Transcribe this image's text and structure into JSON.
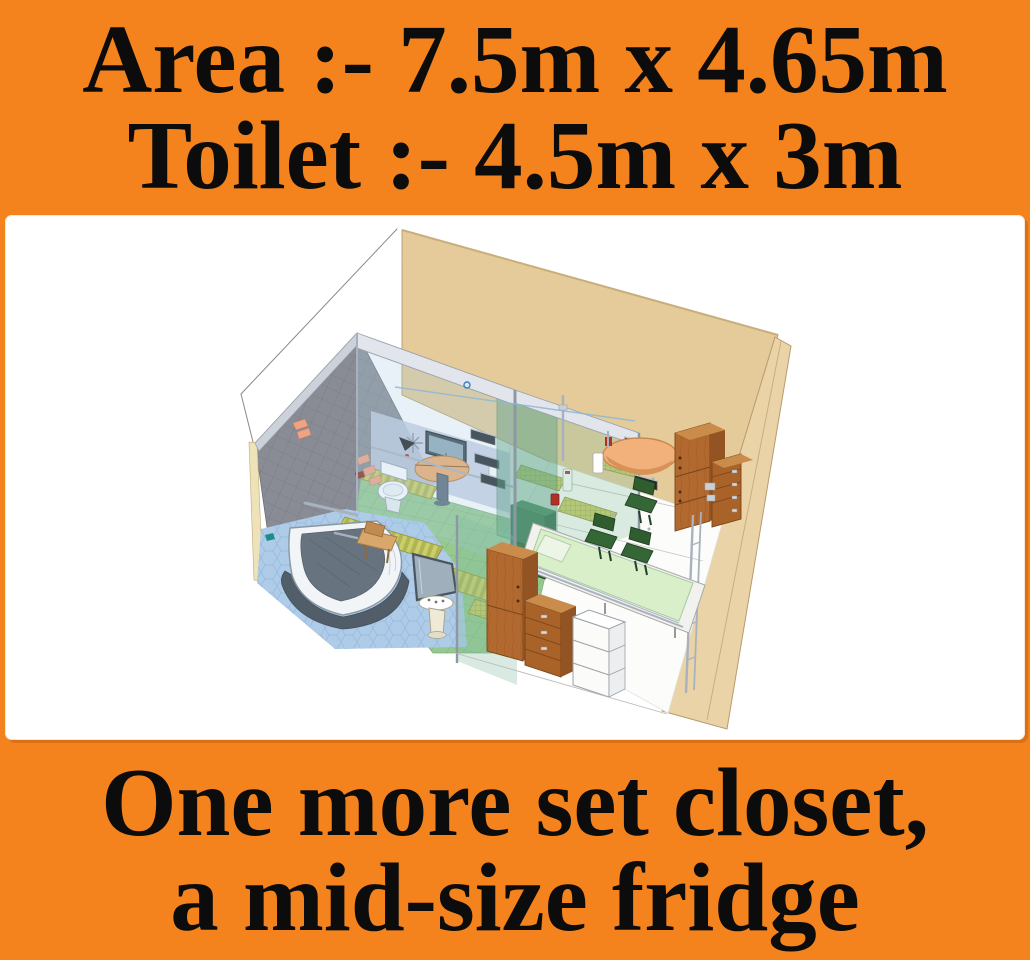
{
  "title": "Room layout promo graphic",
  "header": {
    "line1": "Area :- 7.5m x 4.65m",
    "line2": "Toilet :- 4.5m x 3m"
  },
  "footer": {
    "line1": "One more set closet,",
    "line2": "a mid-size fridge"
  },
  "colors": {
    "background": "#F5831D",
    "panel": "#FFFFFF",
    "text": "#0C0C0C",
    "wireframe": "#8A8A86",
    "back_wall": "#E5CB99",
    "wall_edge": "#C9AE7C",
    "right_wall": "#EAD3A6",
    "gray_wall": "#898C95",
    "cream_strip": "#EDE2B8",
    "wall_cap": "#CDD2DA",
    "inner_wall_blue": "#C5CEE2",
    "floor_white": "#FCFCFB",
    "floor_green": "#95C98F",
    "floor_blue": "#AECBE8",
    "mat_yellow": "#C6CA62",
    "runner_yellow": "#CBCF6A",
    "frame_white": "#E2E6EC",
    "glass_blue": "#A8CDE4",
    "glass_green": "#87BFA5",
    "glass_teal": "#5FA58C",
    "chrome": "#A8B2BE",
    "toilet_white": "#FFFFFF",
    "tv_dark": "#37474F",
    "tv_screen": "#8FA8B8",
    "desk_top": "#EFA96B",
    "desk_leg": "#5A6A78",
    "tub_white": "#F1F5F7",
    "tub_inner": "#67747F",
    "slate": "#515E6A",
    "mirror": "#9FB0BC",
    "sink_cream": "#EFEAD6",
    "stool_wood": "#D8A76B",
    "bag_tan": "#C08A50",
    "wood_front": "#B2692F",
    "wood_side": "#935323",
    "wood_top": "#C98C4B",
    "drawer_wood": "#A96228",
    "fridge_white": "#FBFBFA",
    "fridge_side": "#EDEEEF",
    "bed_deck": "#F1F1EE",
    "bed_green": "#D9EFC9",
    "pillow": "#EDF6E6",
    "chair_green": "#2F5D2F",
    "chair_seat": "#356635",
    "cabinet_green": "#2D6B3F",
    "cabinet_green_side": "#1E4A2B",
    "vanity_peach": "#F2B17A",
    "accent_pink": "#F0A284",
    "accent_red": "#8E2B1E",
    "red_fixture": "#B03226",
    "teal_dish": "#1F8A8A",
    "glyph_blue": "#3A7CC8"
  },
  "scene": {
    "type": "3d-room-render",
    "style": "sketchup-cutaway",
    "objects": [
      "room wireframe",
      "tan back wall",
      "right wall",
      "gray tiled shower wall",
      "glass toilet cubicle",
      "toilet",
      "wall tv",
      "semi-circular desk",
      "corner bathtub",
      "mirror panel",
      "pedestal sink",
      "wooden stool",
      "bath mats",
      "striped runners",
      "green tile floor",
      "blue hex floor",
      "dark green locker",
      "wall-mounted folding seats",
      "vanity basin",
      "tall wardrobe",
      "chest of drawers",
      "wooden cabinet stack",
      "white fridge boxes",
      "platform bed with pillow",
      "three green chairs",
      "chrome rails and fixtures",
      "pink wall accents"
    ]
  }
}
